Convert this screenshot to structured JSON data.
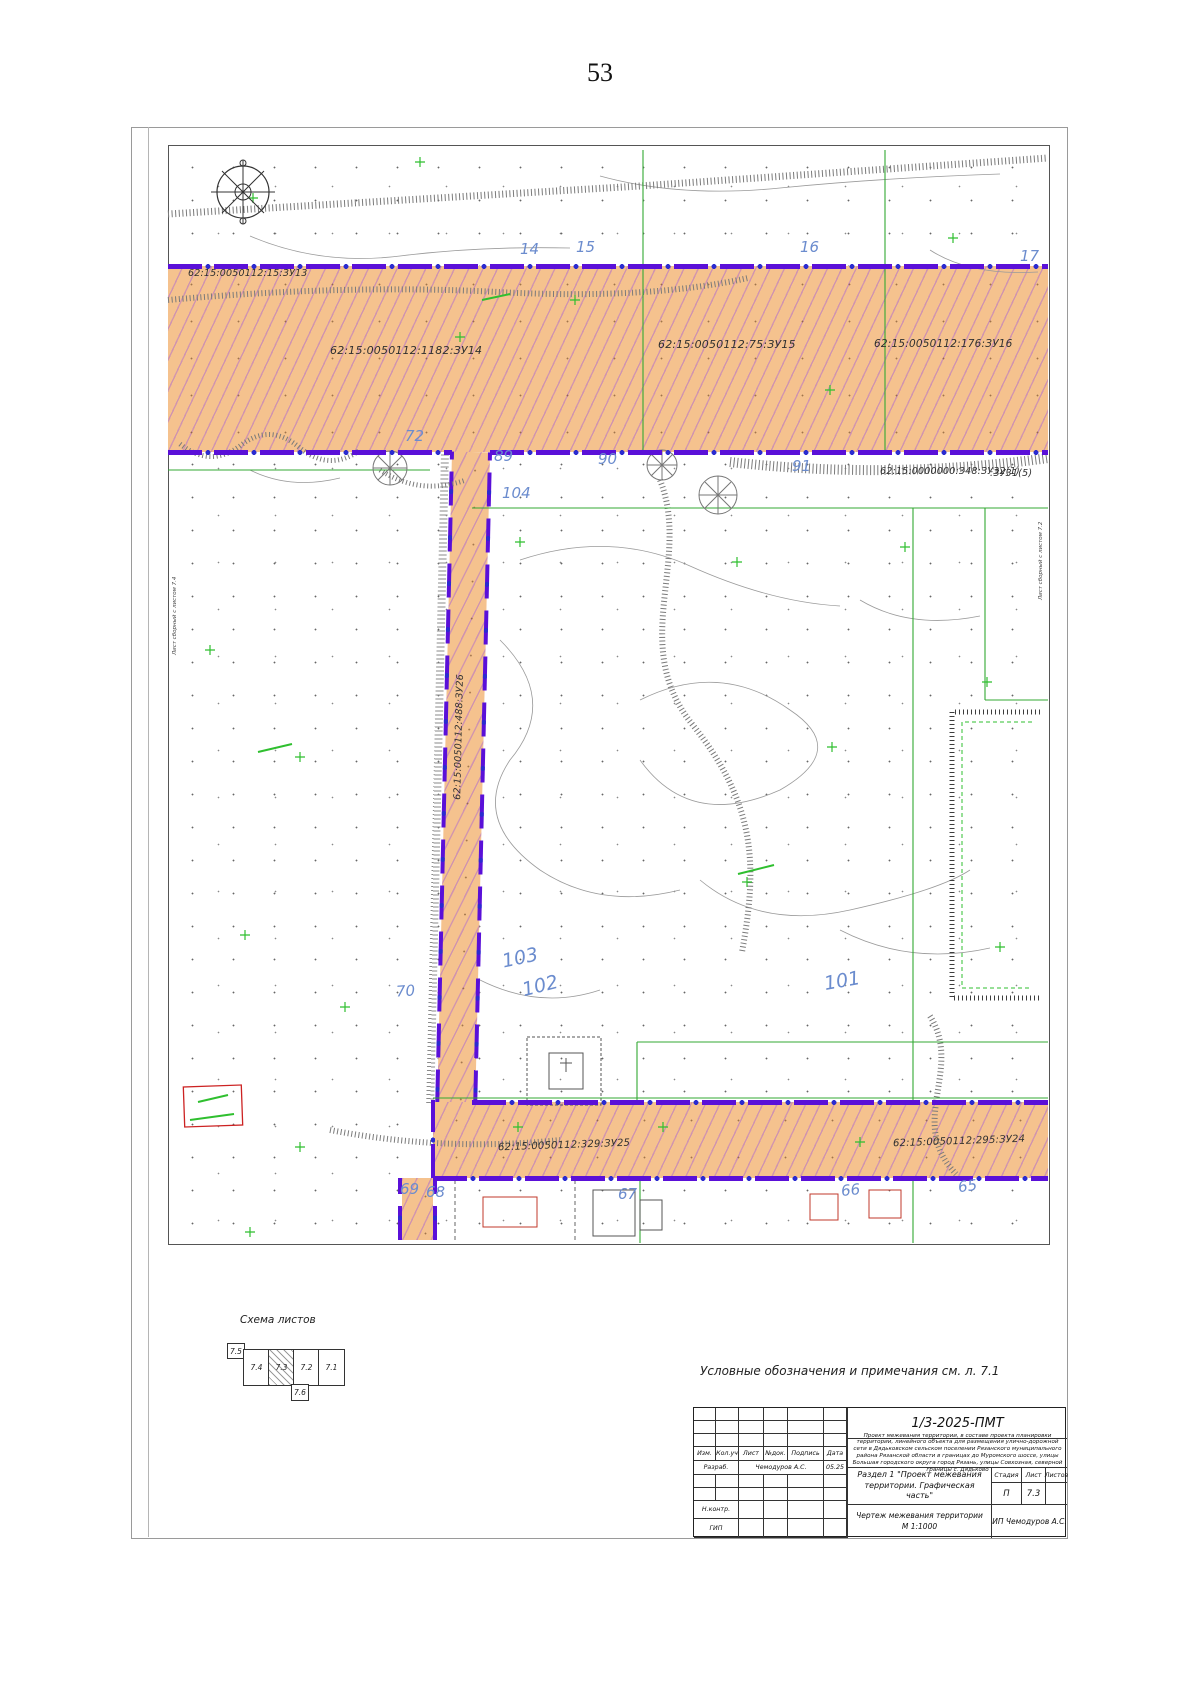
{
  "page_number": "53",
  "map": {
    "point_numbers": [
      "14",
      "15",
      "16",
      "17",
      "72",
      "89",
      "90",
      "91",
      "104",
      "103",
      "102",
      "101",
      "70",
      "69",
      "68",
      "67",
      "66",
      "65"
    ],
    "parcel_labels": [
      "62:15:0050112:15:ЗУ13",
      "62:15:0050112:1182:ЗУ14",
      "62:15:0050112:75:ЗУ15",
      "62:15:0050112:176:ЗУ16",
      "62:15:0000000:348:ЗУ32(1)",
      ":ЗУ31(5)",
      "62:15:0050112:488:ЗУ26",
      "62:15:0050112:329:ЗУ25",
      "62:15:0050112:295:ЗУ24"
    ],
    "edge_labels": {
      "left": "Лист сборный с листом 7.4",
      "right": "Лист сборный с листом 7.2"
    },
    "colors": {
      "parcel_fill": "#f5c28e",
      "parcel_hatch": "#b26eca",
      "boundary_purple": "#5a10d8",
      "cadastral_green": "#33a833",
      "point_number_blue": "#6b8cce"
    }
  },
  "sheet_scheme": {
    "title": "Схема листов",
    "cells": [
      "7.4",
      "7.3",
      "7.2",
      "7.1"
    ],
    "top_cell": "7.5",
    "bottom_cell": "7.6"
  },
  "note": "Условные обозначения и примечания см. л. 7.1",
  "title_block": {
    "doc_code": "1/3-2025-ПМТ",
    "description": "Проект межевания территории, в составе проекта планировки территории, линейного объекта для размещения улично-дорожной сети в Дядьковском сельском поселении Рязанского муниципального района Рязанской области в границах до Муромского шоссе, улицы Большая городского округа город Рязань, улицы Совхозная, северной границы с. Дядьково",
    "columns": [
      "Изм.",
      "Кол.уч",
      "Лист",
      "№док.",
      "Подпись",
      "Дата"
    ],
    "row_developer": {
      "role": "Разраб.",
      "name": "Чемодуров А.С.",
      "date": "05.25"
    },
    "row_ncontrol": "Н.контр.",
    "row_gip": "ГИП",
    "section_title": "Раздел 1 \"Проект межевания территории. Графическая часть\"",
    "stage_headers": [
      "Стадия",
      "Лист",
      "Листов"
    ],
    "stage": "П",
    "sheet": "7.3",
    "sheets_total": "",
    "drawing_title": "Чертеж межевания территории",
    "scale": "М 1:1000",
    "company": "ИП Чемодуров А.С."
  }
}
